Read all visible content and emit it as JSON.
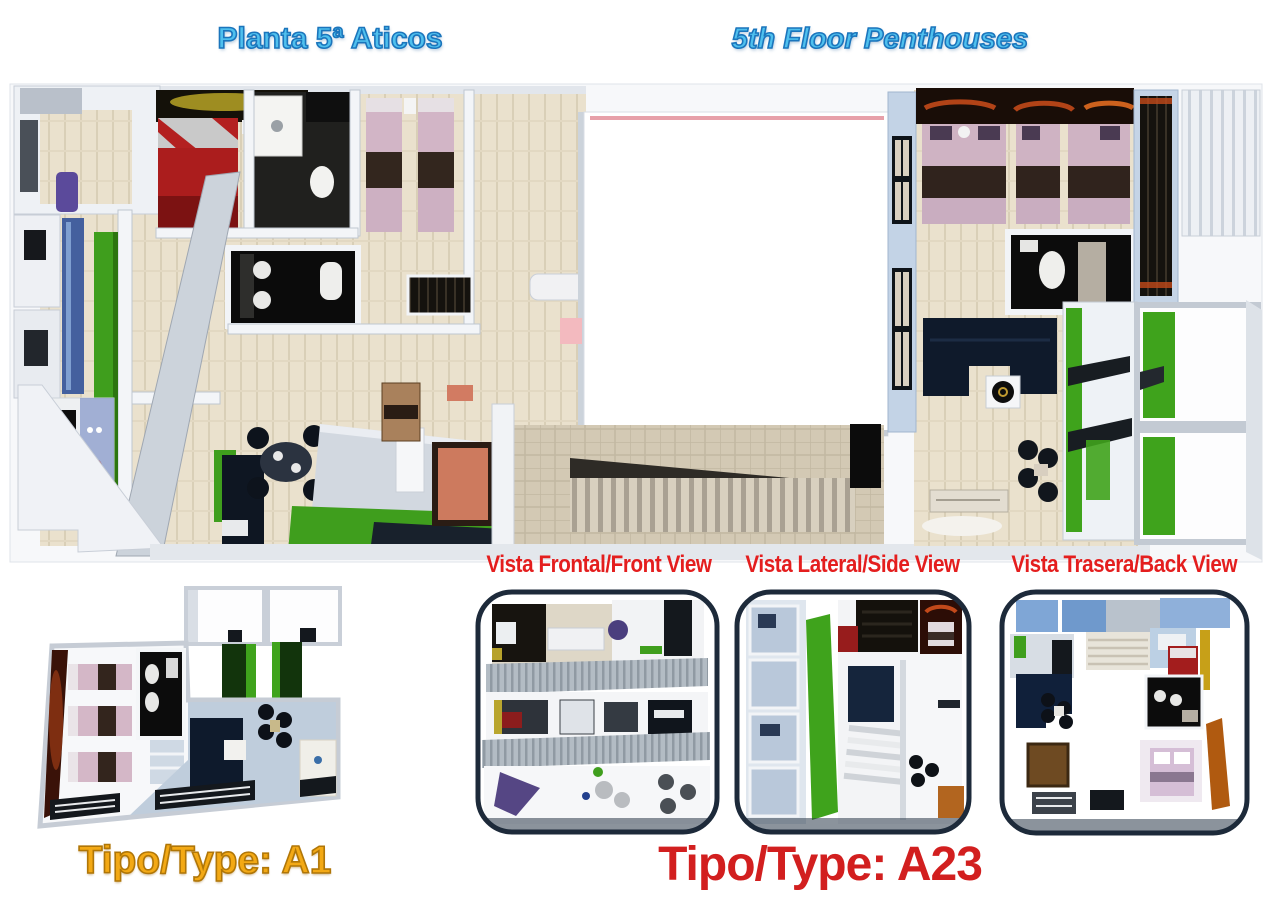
{
  "page": {
    "background": "#FFFFFF"
  },
  "header": {
    "title_left": "Planta 5ª Aticos",
    "title_right": "5th Floor Penthouses",
    "text_fill": "#4FC0EE",
    "text_outline": "#1B75BC"
  },
  "views": {
    "label_color": "#E41E1E",
    "labels": [
      "Vista Frontal/Front View",
      "Vista Lateral/Side View",
      "Vista Trasera/Back View"
    ]
  },
  "unit_types": {
    "a1": {
      "label": "Tipo/Type: A1",
      "fill": "#F3A915",
      "outline": "#B07607"
    },
    "a23": {
      "label": "Tipo/Type: A23",
      "color": "#D21F1F"
    }
  },
  "floorplan_palette": {
    "wall": "#F1F3F6",
    "wall_shadow": "#C8CED7",
    "floor_tile_beige": "#EAE1CD",
    "corridor_tile": "#D3C9B4",
    "grass_green": "#3FA31C",
    "bed_red": "#AB1D1D",
    "bed_pink": "#D2B5C6",
    "bed_brown_band": "#33261E",
    "sofa_navy": "#101D30",
    "bathroom_black": "#0C0C0C",
    "glass_blue": "#44609E",
    "wall_blue_gray": "#C3D3E6",
    "courtyard_pink_line": "#E7A0A9",
    "salmon_room": "#CD7A5E",
    "thumb_border_navy": "#1D2A3A",
    "glow_orange": "#C2491A"
  }
}
